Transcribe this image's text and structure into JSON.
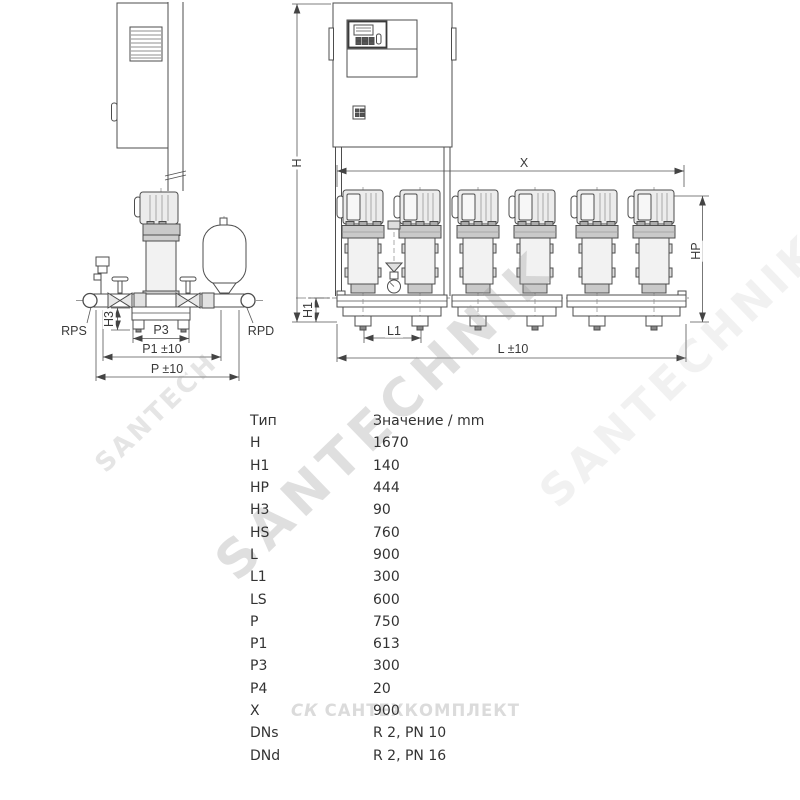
{
  "left_diagram": {
    "labels": {
      "rps": "RPS",
      "rpd": "RPD",
      "h3": "H3",
      "p3": "P3",
      "p1": "P1 ±10",
      "p": "P ±10"
    }
  },
  "right_diagram": {
    "labels": {
      "h": "H",
      "h1": "H1",
      "x": "X",
      "hp": "HP",
      "l1": "L1",
      "l": "L ±10"
    }
  },
  "dimensions_table": {
    "col_type": "Тип",
    "col_value": "Значение / mm",
    "rows": [
      {
        "type": "H",
        "value": "1670"
      },
      {
        "type": "H1",
        "value": "140"
      },
      {
        "type": "HP",
        "value": "444"
      },
      {
        "type": "H3",
        "value": "90"
      },
      {
        "type": "HS",
        "value": "760"
      },
      {
        "type": "L",
        "value": "900"
      },
      {
        "type": "L1",
        "value": "300"
      },
      {
        "type": "LS",
        "value": "600"
      },
      {
        "type": "P",
        "value": "750"
      },
      {
        "type": "P1",
        "value": "613"
      },
      {
        "type": "P3",
        "value": "300"
      },
      {
        "type": "P4",
        "value": "20"
      },
      {
        "type": "X",
        "value": "900"
      },
      {
        "type": "DNs",
        "value": "R 2, PN 10"
      },
      {
        "type": "DNd",
        "value": "R 2, PN 16"
      }
    ]
  },
  "watermarks": {
    "diagonal_main": "SANTECHNIK",
    "diagonal_small": "SANTECH",
    "diagonal_faint": "SANTECHNIK",
    "horizontal_logo": "СК",
    "horizontal_text": "САНТЕХКОМПЛЕКТ"
  },
  "colors": {
    "line": "#4d4d4d",
    "dimension_line": "#555555",
    "table_text": "#333333",
    "watermark_gray": "#dcdcdc"
  }
}
